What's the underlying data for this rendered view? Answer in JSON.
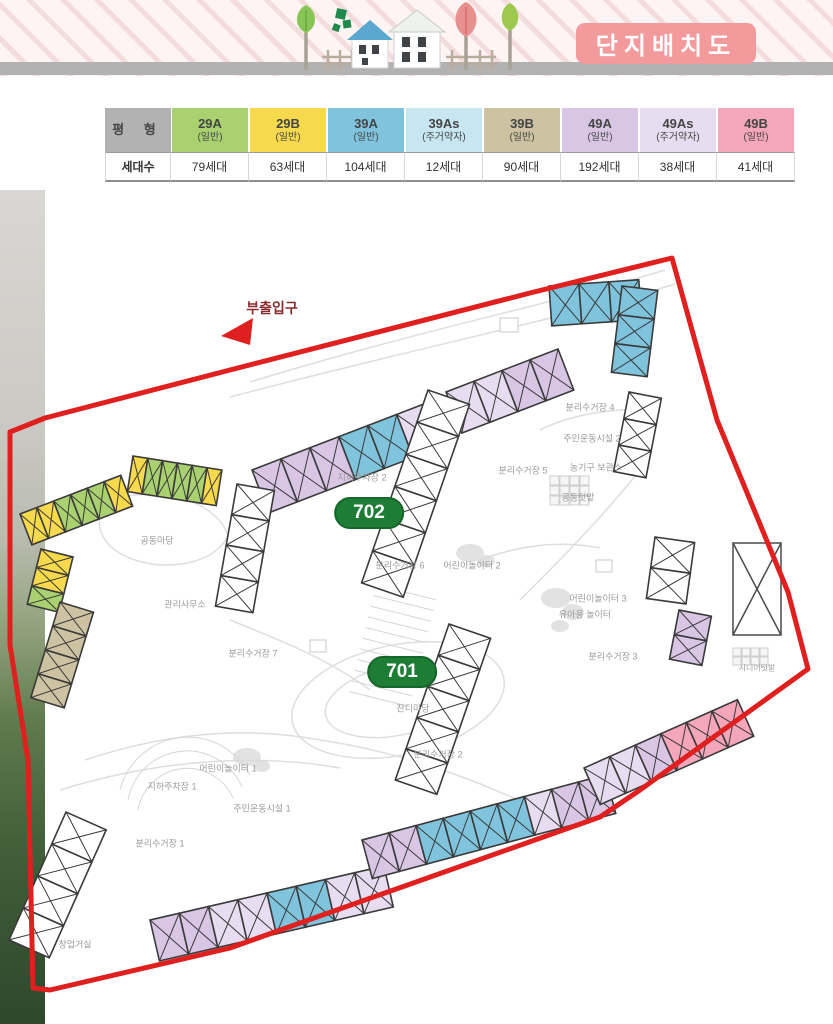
{
  "page": {
    "title_badge": "단지배치도"
  },
  "legend_table": {
    "row1_header": "평 형",
    "row2_header": "세대수",
    "columns": [
      {
        "type": "29A",
        "category": "(일반)",
        "households": "79세대",
        "color": "#a9d170"
      },
      {
        "type": "29B",
        "category": "(일반)",
        "households": "63세대",
        "color": "#f6d94d"
      },
      {
        "type": "39A",
        "category": "(일반)",
        "households": "104세대",
        "color": "#7fc4dc"
      },
      {
        "type": "39As",
        "category": "(주거약자)",
        "households": "12세대",
        "color": "#c8e6f2"
      },
      {
        "type": "39B",
        "category": "(일반)",
        "households": "90세대",
        "color": "#cdc3a2"
      },
      {
        "type": "49A",
        "category": "(일반)",
        "households": "192세대",
        "color": "#d9c6e4"
      },
      {
        "type": "49As",
        "category": "(주거약자)",
        "households": "38세대",
        "color": "#e8dcf0"
      },
      {
        "type": "49B",
        "category": "(일반)",
        "households": "41세대",
        "color": "#f4a7bb"
      }
    ]
  },
  "map": {
    "boundary_color": "#e01f1f",
    "badge_color": "#1e7d35",
    "building_badges": {
      "b702": "702",
      "b701": "701"
    },
    "labels": {
      "sub_entrance": "부출입구",
      "underground_parking_2": "지하주차장 2",
      "recycling_4": "분리수거장 4",
      "exercise_facility_2": "주민운동시설 2",
      "farm_tool_storage": "농기구 보관소",
      "recycling_5": "분리수거장 5",
      "community_garden": "공동텃밭",
      "common_yard": "공동마당",
      "management_office": "관리사무소",
      "recycling_6": "분리수거장 6",
      "children_playground_2": "어린이놀이터 2",
      "recycling_7": "분리수거장 7",
      "lawn_yard": "잔디마당",
      "recycling_2": "분리수거장 2",
      "children_playground_3": "어린이놀이터 3",
      "toddler_playground": "유아용 놀이터",
      "recycling_3": "분리수거장 3",
      "senior_garden": "시니어텃밭",
      "children_playground_1": "어린이놀이터 1",
      "underground_parking_1": "지하주차장 1",
      "exercise_facility_1": "주민운동시설 1",
      "recycling_1": "분리수거장 1",
      "startup_room": "창업거실"
    },
    "buildings": [
      {
        "id": "w1a",
        "cells": [
          "49A",
          "49A",
          "49A",
          "39A",
          "39A",
          "49As"
        ]
      },
      {
        "id": "w1b",
        "cells": [
          "49As",
          "49As",
          "49A",
          "49A"
        ]
      },
      {
        "id": "w2",
        "cells": [
          "39A",
          "39A",
          "39A"
        ]
      },
      {
        "id": "w3",
        "cells": [
          "39A",
          "39A",
          "39A"
        ]
      },
      {
        "id": "w4",
        "cells": [
          "OPEN",
          "OPEN",
          "OPEN"
        ]
      },
      {
        "id": "w5",
        "cells": [
          "OPEN",
          "OPEN",
          "OPEN",
          "OPEN",
          "OPEN",
          "OPEN"
        ]
      },
      {
        "id": "w6",
        "cells": [
          "OPEN",
          "OPEN",
          "OPEN",
          "OPEN"
        ]
      },
      {
        "id": "w7",
        "cells": [
          "29B",
          "29A",
          "29A",
          "29A",
          "29A",
          "29B"
        ]
      },
      {
        "id": "w8",
        "cells": [
          "29B",
          "29B",
          "29A",
          "29A",
          "29A",
          "29B"
        ]
      },
      {
        "id": "w9",
        "cells": [
          "29B",
          "29B",
          "29A"
        ]
      },
      {
        "id": "w10",
        "cells": [
          "39B",
          "39B",
          "39B",
          "39B"
        ]
      },
      {
        "id": "w11",
        "cells": [
          "OPEN",
          "OPEN",
          "OPEN",
          "OPEN"
        ]
      },
      {
        "id": "w12",
        "cells": [
          "49A",
          "49A",
          "49As",
          "49As",
          "39A",
          "39A",
          "49As",
          "49As"
        ]
      },
      {
        "id": "w13",
        "cells": [
          "49A",
          "49A",
          "39A",
          "39A",
          "39A",
          "39A",
          "49As",
          "49A",
          "49A"
        ]
      },
      {
        "id": "w14",
        "cells": [
          "49As",
          "49As",
          "49A",
          "49B",
          "49B",
          "49B"
        ]
      },
      {
        "id": "w15",
        "cells": [
          "49A",
          "49A"
        ]
      },
      {
        "id": "w16",
        "cells": [
          "OPEN",
          "OPEN"
        ]
      },
      {
        "id": "w17",
        "cells": [
          "OPEN",
          "OPEN",
          "OPEN",
          "OPEN",
          "OPEN"
        ]
      }
    ]
  }
}
